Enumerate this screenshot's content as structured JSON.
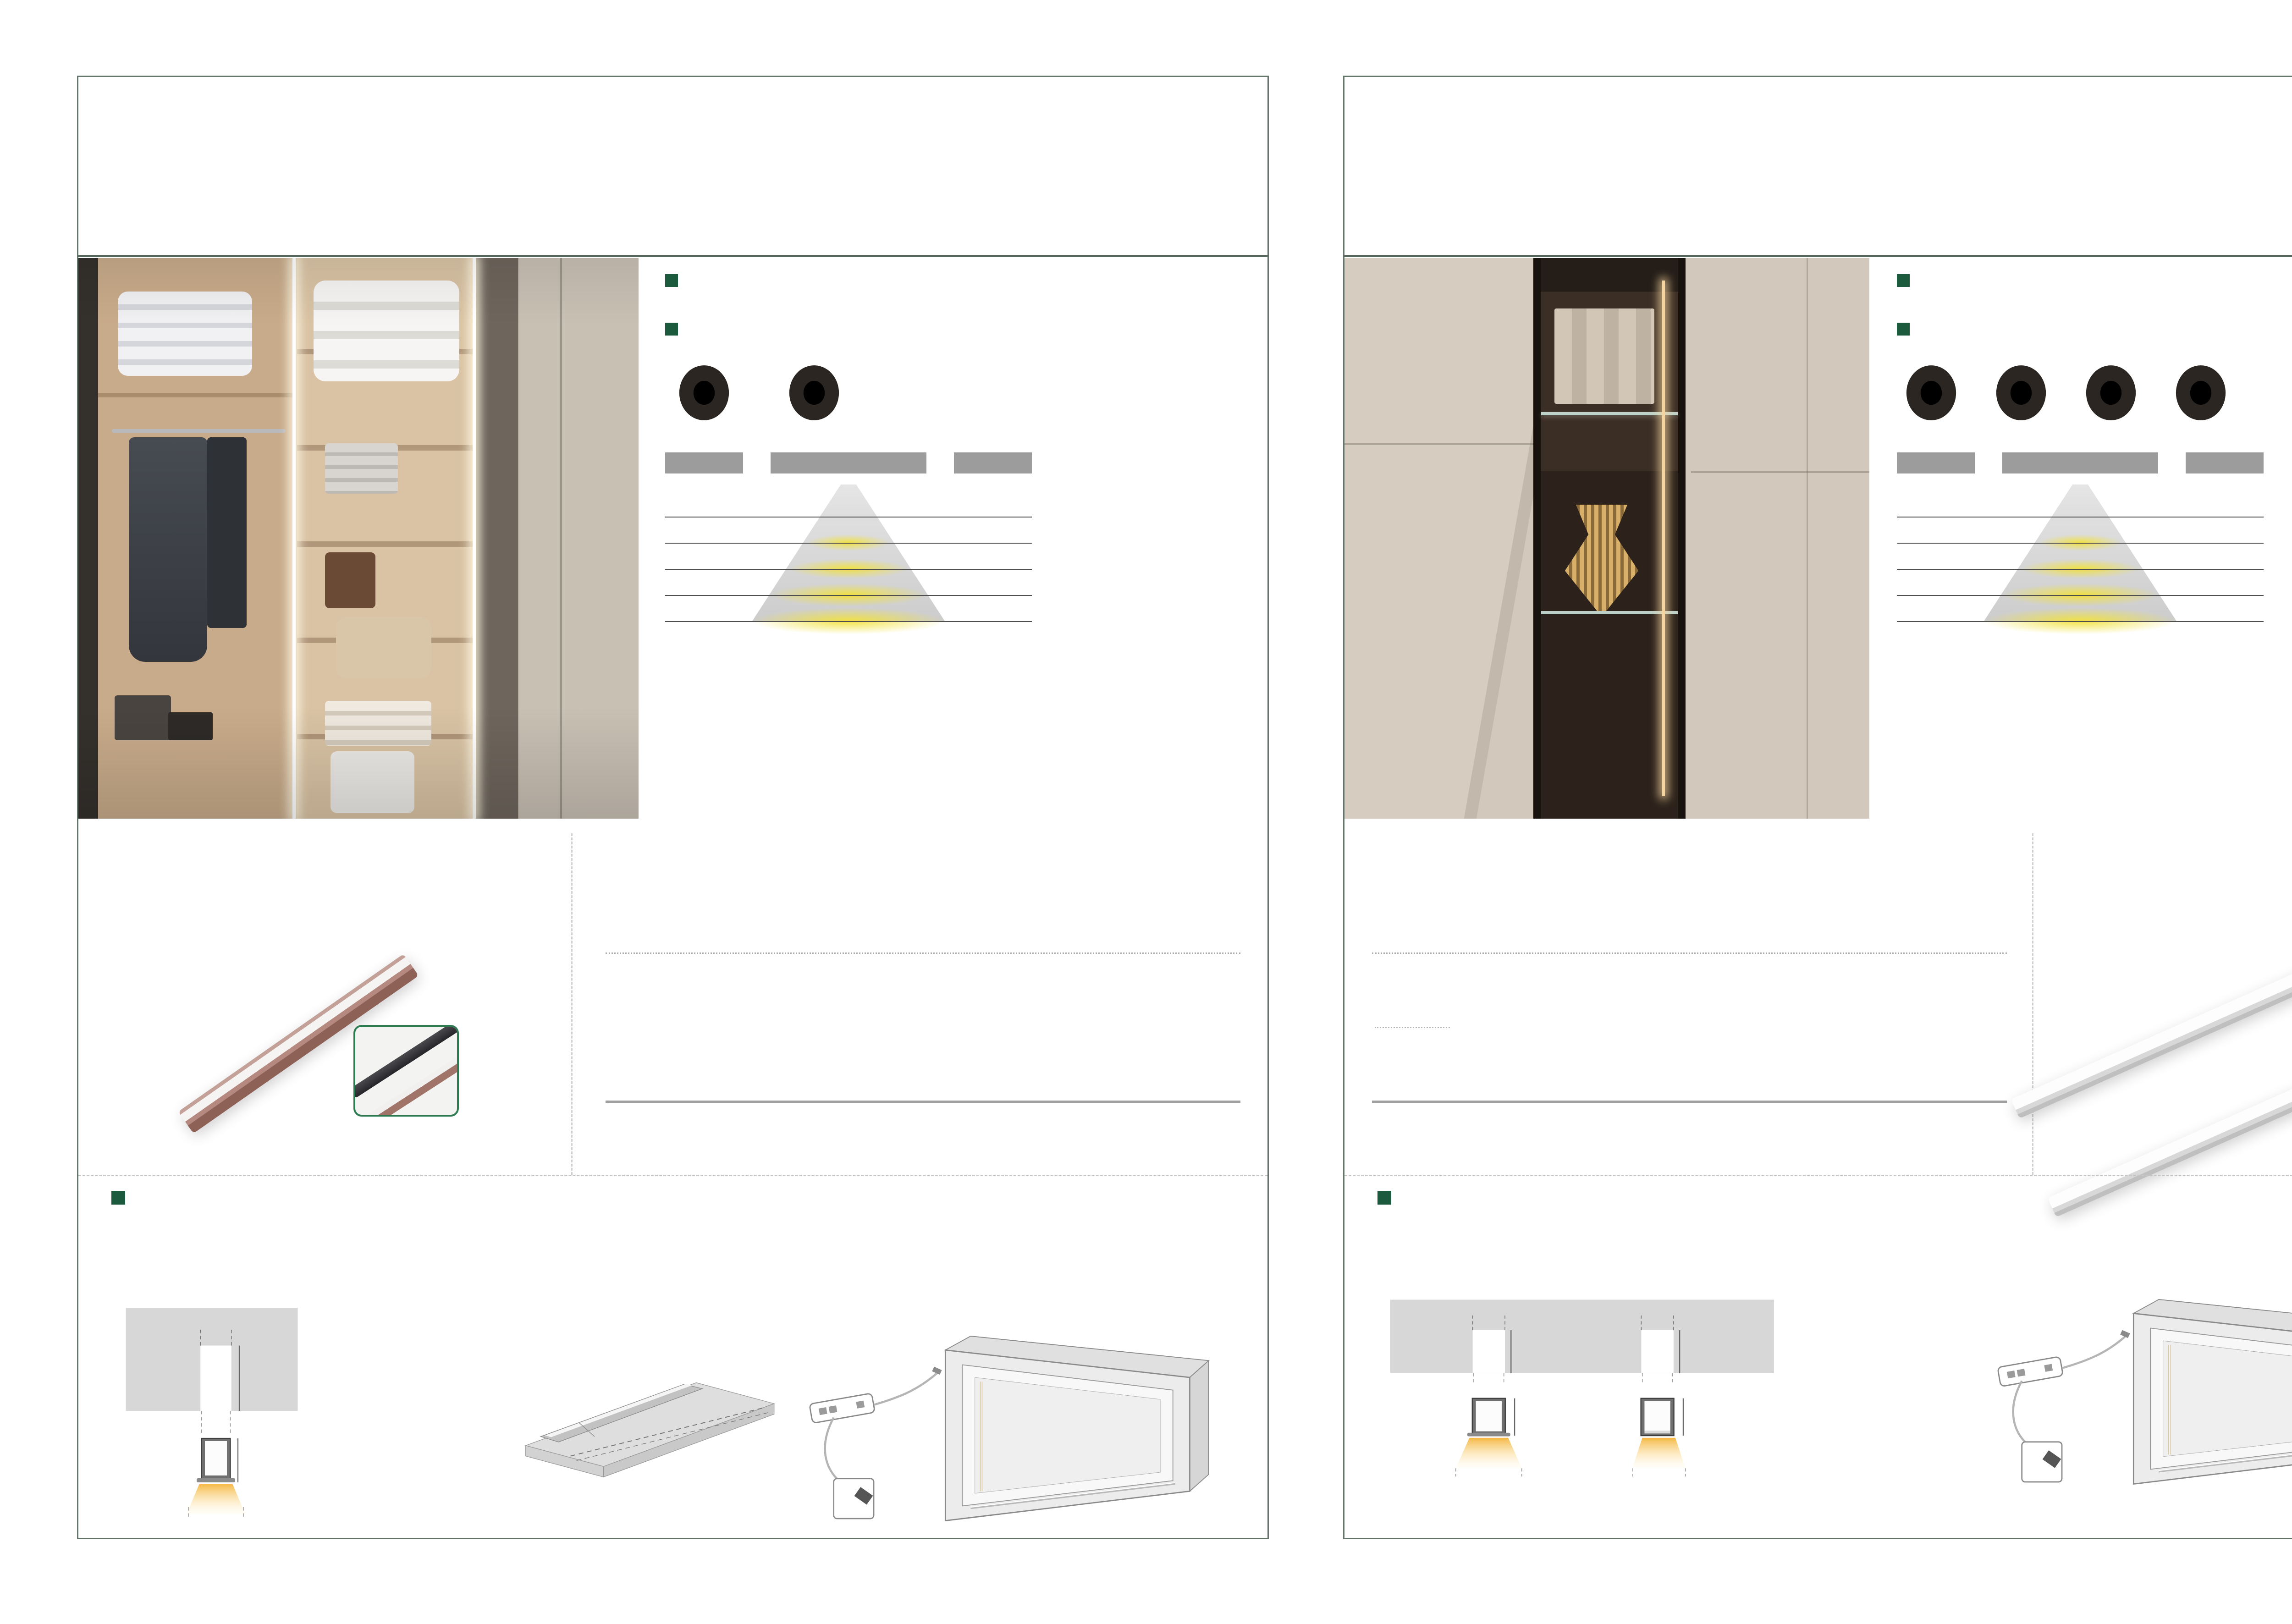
{
  "colors": {
    "brand_green": "#1b5a3c",
    "note_green": "#0e7a49",
    "bar_gray": "#9c9c9c",
    "frame": "#66756b"
  },
  "shared": {
    "features_heading": "产品特点 / Product features",
    "scope_heading": "适用范围 / Scope of application",
    "scope_text": "橱柜柜底、柜内、高柜、衣柜、酒柜、装饰柜、展柜等。",
    "install_heading": "安装参数图 / Installation Parameter Diagram",
    "cut_zh": "长度可随意裁切，可定制尺寸",
    "cut_en": "Length can be cut and customized",
    "power_zh": "工作电压:DC12V电源适配器",
    "power_en": "Power: DC12V adaptor",
    "side_mount": "侧装",
    "top_mount": "顶装"
  },
  "light_chart": {
    "type": "table",
    "kelvin": "6500K",
    "angle": "90",
    "angle_sup": "0",
    "distance_label": "distance",
    "rows": [
      {
        "lx": "200lx",
        "mm": "250mm"
      },
      {
        "lx": "88lx",
        "mm": "500mm"
      },
      {
        "lx": "45lx",
        "mm": "750mm"
      },
      {
        "lx": "33lx",
        "mm": "1000mm"
      }
    ]
  },
  "note": {
    "prefix": "注：以上尺寸为常规尺寸 ",
    "highlight": "其他任意尺寸可定制"
  },
  "table_headers": [
    {
      "zh": "型号",
      "en": "Model"
    },
    {
      "zh": "产品规格",
      "en": "L x D x H"
    },
    {
      "zh": "功率",
      "en": "Power"
    },
    {
      "zh": "色温",
      "en": "CCT(K)"
    },
    {
      "zh": "开关方式",
      "en": "Switch mode"
    },
    {
      "zh": "安装要点",
      "en": "Installation"
    },
    {
      "zh": "表面处理",
      "en": "Surface treatment"
    }
  ],
  "page_left": {
    "page_no": "181",
    "title": "K01-28A",
    "subtitle_zh": "迷你·纤细内嵌灯条",
    "subtitle_en": "Recessed ligth",
    "features": [
      "嵌入式安装，简单便捷，用途广泛；",
      "超窄灯槽设计，超薄PC罩，无光点光效\n使发光线条更加精致。",
      "两边堵头弧形打磨设计，圆滑流畅，与槽边完美贴合。"
    ],
    "icons": [
      {
        "zh": "中性光",
        "en": "Cool White",
        "color": "#f7edd3"
      },
      {
        "zh": "暖白光",
        "en": "Warm White",
        "color": "#f3c87c"
      }
    ],
    "table_row": {
      "model": "K01-28A",
      "size": "1000×9.8x8.7mm",
      "power": "10w",
      "cct": "3000K\n4000K\n6000K\n冰蓝光",
      "switch": "接线(A)",
      "install": "开槽尺寸\n宽8mm\n深9mm",
      "surface": "咖啡色\n氧化铝本色"
    },
    "inset_caption": "比笔 还要纤细的灯条",
    "legend": [
      "L  ：产品长度尺寸",
      "L1:开槽有效尺寸",
      "L1=L-16mm"
    ],
    "cross": {
      "top": "8mm",
      "depth": "9mm",
      "mid": "7.2mm",
      "height": "8.7mm",
      "bottom": "9.8mm"
    },
    "iso": {
      "w": "宽度(W) 7.5~8mm",
      "d": "深度(D) 8.5~9mm",
      "L": "L",
      "L16": "L-16mm",
      "caption": "建议开槽尺寸"
    }
  },
  "page_right": {
    "page_no": "182",
    "title": "K01-29A",
    "subtitle_zh": "零间隙层版条形灯",
    "subtitle_en": "Recessed mounting LED light",
    "features": [
      "灯带直通不断，PC罩随意断，安装完后，再盖灯罩；",
      "超窄灯槽设计，超薄PC罩，无光点光效\n使发光线条更加精致。",
      "嵌入式安装，简单便捷，用途广泛。"
    ],
    "icons": [
      {
        "zh": "冰蓝光",
        "en": "Basset",
        "color": "#8fd4f0"
      },
      {
        "zh": "超白光",
        "en": "White",
        "color": "#ffffff"
      },
      {
        "zh": "中性光",
        "en": "Cool White",
        "color": "#f7edd3"
      },
      {
        "zh": "暖白光",
        "en": "Warm White",
        "color": "#f3c87c"
      }
    ],
    "table_row": {
      "models": [
        "K01-29A-2",
        "K01-29A-3"
      ],
      "size": "1000×7.2x8.1mm",
      "power": "10w",
      "cct": "3000K\n4000K\n6000K\n冰蓝光",
      "switch": "接线(A)",
      "install": "开槽尺寸\n宽7.5mm\n深8.5mm",
      "surface": "氧化铝本色"
    },
    "bar_labels": [
      "K01-29A-2",
      "K01-29A-3"
    ],
    "cross": {
      "top": "7.5mm",
      "depth": "8.5mm",
      "mid": "7.2mm",
      "height": "8.1mm",
      "bottom_a": "10.2mm",
      "bottom_b": "7.2mm",
      "cap_a1": "(K01-29A-2)",
      "cap_a2": "PC罩边延外盖设计",
      "cap_b1": "(K01-29A-3)",
      "cap_b2": "PC罩内嵌设计"
    }
  }
}
